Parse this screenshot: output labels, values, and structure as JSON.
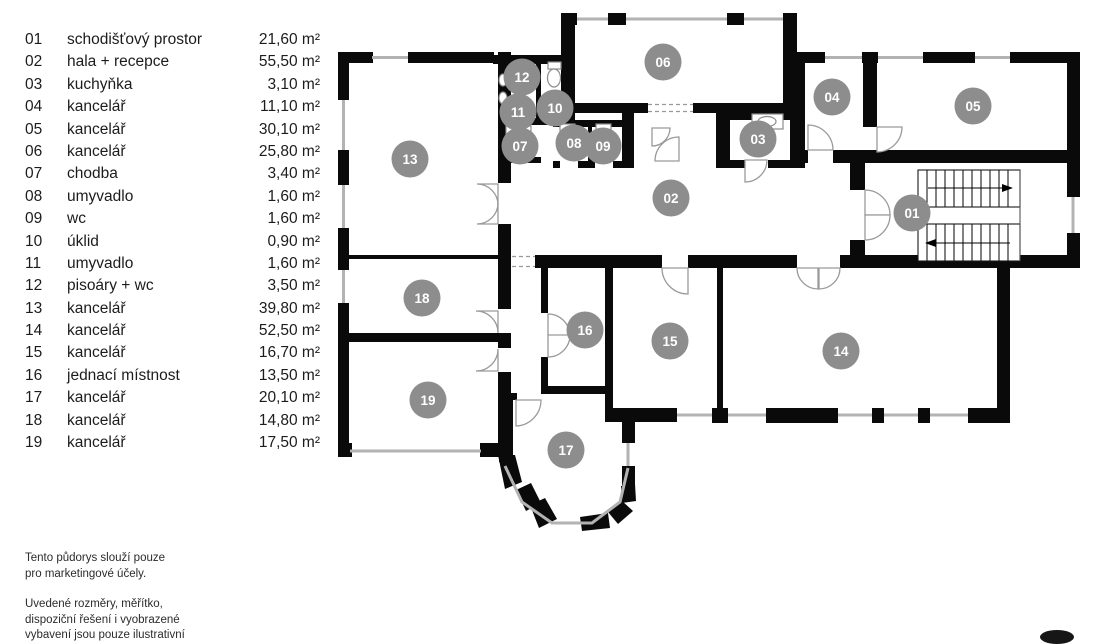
{
  "legend": {
    "rows": [
      {
        "no": "01",
        "name": "schodišťový prostor",
        "area": "21,60 m²"
      },
      {
        "no": "02",
        "name": "hala + recepce",
        "area": "55,50 m²"
      },
      {
        "no": "03",
        "name": "kuchyňka",
        "area": "3,10 m²"
      },
      {
        "no": "04",
        "name": "kancelář",
        "area": "11,10 m²"
      },
      {
        "no": "05",
        "name": "kancelář",
        "area": "30,10 m²"
      },
      {
        "no": "06",
        "name": "kancelář",
        "area": "25,80 m²"
      },
      {
        "no": "07",
        "name": "chodba",
        "area": "3,40 m²"
      },
      {
        "no": "08",
        "name": "umyvadlo",
        "area": "1,60 m²"
      },
      {
        "no": "09",
        "name": "wc",
        "area": "1,60 m²"
      },
      {
        "no": "10",
        "name": "úklid",
        "area": "0,90 m²"
      },
      {
        "no": "11",
        "name": "umyvadlo",
        "area": "1,60 m²"
      },
      {
        "no": "12",
        "name": "pisoáry + wc",
        "area": "3,50 m²"
      },
      {
        "no": "13",
        "name": "kancelář",
        "area": "39,80 m²"
      },
      {
        "no": "14",
        "name": "kancelář",
        "area": "52,50 m²"
      },
      {
        "no": "15",
        "name": "kancelář",
        "area": "16,70 m²"
      },
      {
        "no": "16",
        "name": "jednací místnost",
        "area": "13,50 m²"
      },
      {
        "no": "17",
        "name": "kancelář",
        "area": "20,10 m²"
      },
      {
        "no": "18",
        "name": "kancelář",
        "area": "14,80 m²"
      },
      {
        "no": "19",
        "name": "kancelář",
        "area": "17,50 m²"
      }
    ]
  },
  "footnotes": {
    "p1_line1": "Tento půdorys slouží pouze",
    "p1_line2": "pro marketingové účely.",
    "p2_line1": "Uvedené rozměry, měřítko,",
    "p2_line2": "dispoziční řešení i vyobrazené",
    "p2_line3": "vybavení jsou pouze ilustrativní"
  },
  "plan": {
    "colors": {
      "wall": "#0a0a0a",
      "window": "#b3b3b3",
      "door": "#9a9a9a",
      "room_circle": "#8d8d8d",
      "circle_text": "#ffffff"
    },
    "labels": [
      {
        "id": "01",
        "x": 912,
        "y": 213
      },
      {
        "id": "02",
        "x": 671,
        "y": 198
      },
      {
        "id": "03",
        "x": 758,
        "y": 139
      },
      {
        "id": "04",
        "x": 832,
        "y": 97
      },
      {
        "id": "05",
        "x": 973,
        "y": 106
      },
      {
        "id": "06",
        "x": 663,
        "y": 62
      },
      {
        "id": "07",
        "x": 520,
        "y": 146
      },
      {
        "id": "08",
        "x": 574,
        "y": 143
      },
      {
        "id": "09",
        "x": 603,
        "y": 146
      },
      {
        "id": "10",
        "x": 555,
        "y": 108
      },
      {
        "id": "11",
        "x": 518,
        "y": 112
      },
      {
        "id": "12",
        "x": 522,
        "y": 77
      },
      {
        "id": "13",
        "x": 410,
        "y": 159
      },
      {
        "id": "14",
        "x": 841,
        "y": 351
      },
      {
        "id": "15",
        "x": 670,
        "y": 341
      },
      {
        "id": "16",
        "x": 585,
        "y": 330
      },
      {
        "id": "17",
        "x": 566,
        "y": 450
      },
      {
        "id": "18",
        "x": 422,
        "y": 298
      },
      {
        "id": "19",
        "x": 428,
        "y": 400
      }
    ]
  }
}
